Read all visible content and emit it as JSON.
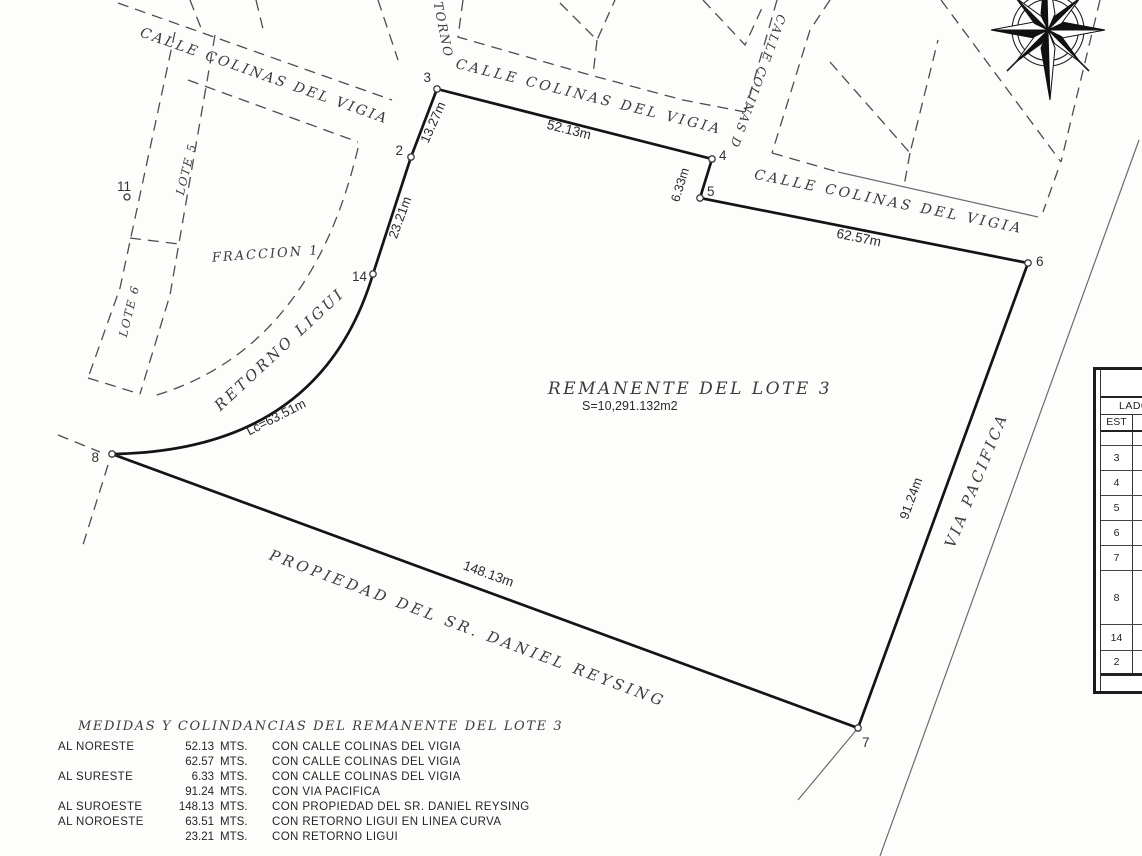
{
  "map": {
    "parcel_name": "REMANENTE  DEL  LOTE  3",
    "parcel_area": "S=10,291.132m2",
    "streets": {
      "calle_colinas_upper_left": "CALLE  COLINAS  DEL  VIGIA",
      "calle_colinas_top": "CALLE  COLINAS  DEL  VIGIA",
      "calle_colinas_right": "CALLE  COLINAS  DEL  VIGIA",
      "calle_colinas_cross": "CALLE  COLINAS  D",
      "retorno_top": "RETORNO",
      "retorno_ligui": "RETORNO  LIGUI",
      "via_pacifica": "VIA  PACIFICA"
    },
    "lots": {
      "fraccion_1": "FRACCION  1",
      "lote_5": "LOTE  5",
      "lote_6": "LOTE  6",
      "neighbor_south": "PROPIEDAD  DEL  SR.  DANIEL  REYSING"
    },
    "measurements": {
      "seg_2_3": "13.27m",
      "seg_3_4": "52.13m",
      "seg_4_5": "6.33m",
      "seg_5_6": "62.57m",
      "seg_6_7": "91.24m",
      "seg_8_7": "148.13m",
      "curve_8_14": "Lc=63.51m",
      "seg_14_2": "23.21m"
    },
    "vertices": {
      "v2": "2",
      "v3": "3",
      "v4": "4",
      "v5": "5",
      "v6": "6",
      "v7": "7",
      "v8": "8",
      "v11": "11",
      "v14": "14"
    }
  },
  "legend": {
    "title": "MEDIDAS  Y  COLINDANCIAS  DEL  REMANENTE  DEL  LOTE  3",
    "rows": [
      {
        "direction": "AL  NORESTE",
        "distance": "52.13",
        "unit": "MTS.",
        "boundary": "CON  CALLE  COLINAS  DEL  VIGIA"
      },
      {
        "direction": "",
        "distance": "62.57",
        "unit": "MTS.",
        "boundary": "CON  CALLE  COLINAS  DEL  VIGIA"
      },
      {
        "direction": "AL  SURESTE",
        "distance": "6.33",
        "unit": "MTS.",
        "boundary": "CON  CALLE  COLINAS  DEL  VIGIA"
      },
      {
        "direction": "",
        "distance": "91.24",
        "unit": "MTS.",
        "boundary": "CON  VIA  PACIFICA"
      },
      {
        "direction": "AL  SUROESTE",
        "distance": "148.13",
        "unit": "MTS.",
        "boundary": "CON  PROPIEDAD  DEL  SR.  DANIEL  REYSING"
      },
      {
        "direction": "AL  NOROESTE",
        "distance": "63.51",
        "unit": "MTS.",
        "boundary": "CON  RETORNO  LIGUI  EN  LINEA  CURVA"
      },
      {
        "direction": "",
        "distance": "23.21",
        "unit": "MTS.",
        "boundary": "CON  RETORNO  LIGUI"
      }
    ]
  },
  "side_table": {
    "group_header": "LADO",
    "col_est": "EST",
    "col_pv": "PV",
    "rows": [
      {
        "est": "",
        "pv": ""
      },
      {
        "est": "3",
        "pv": ""
      },
      {
        "est": "4",
        "pv": ""
      },
      {
        "est": "5",
        "pv": ""
      },
      {
        "est": "6",
        "pv": ""
      },
      {
        "est": "7",
        "pv": ""
      },
      {
        "est": "8",
        "pv": "14"
      },
      {
        "est": "14",
        "pv": ""
      },
      {
        "est": "2",
        "pv": ""
      }
    ]
  }
}
